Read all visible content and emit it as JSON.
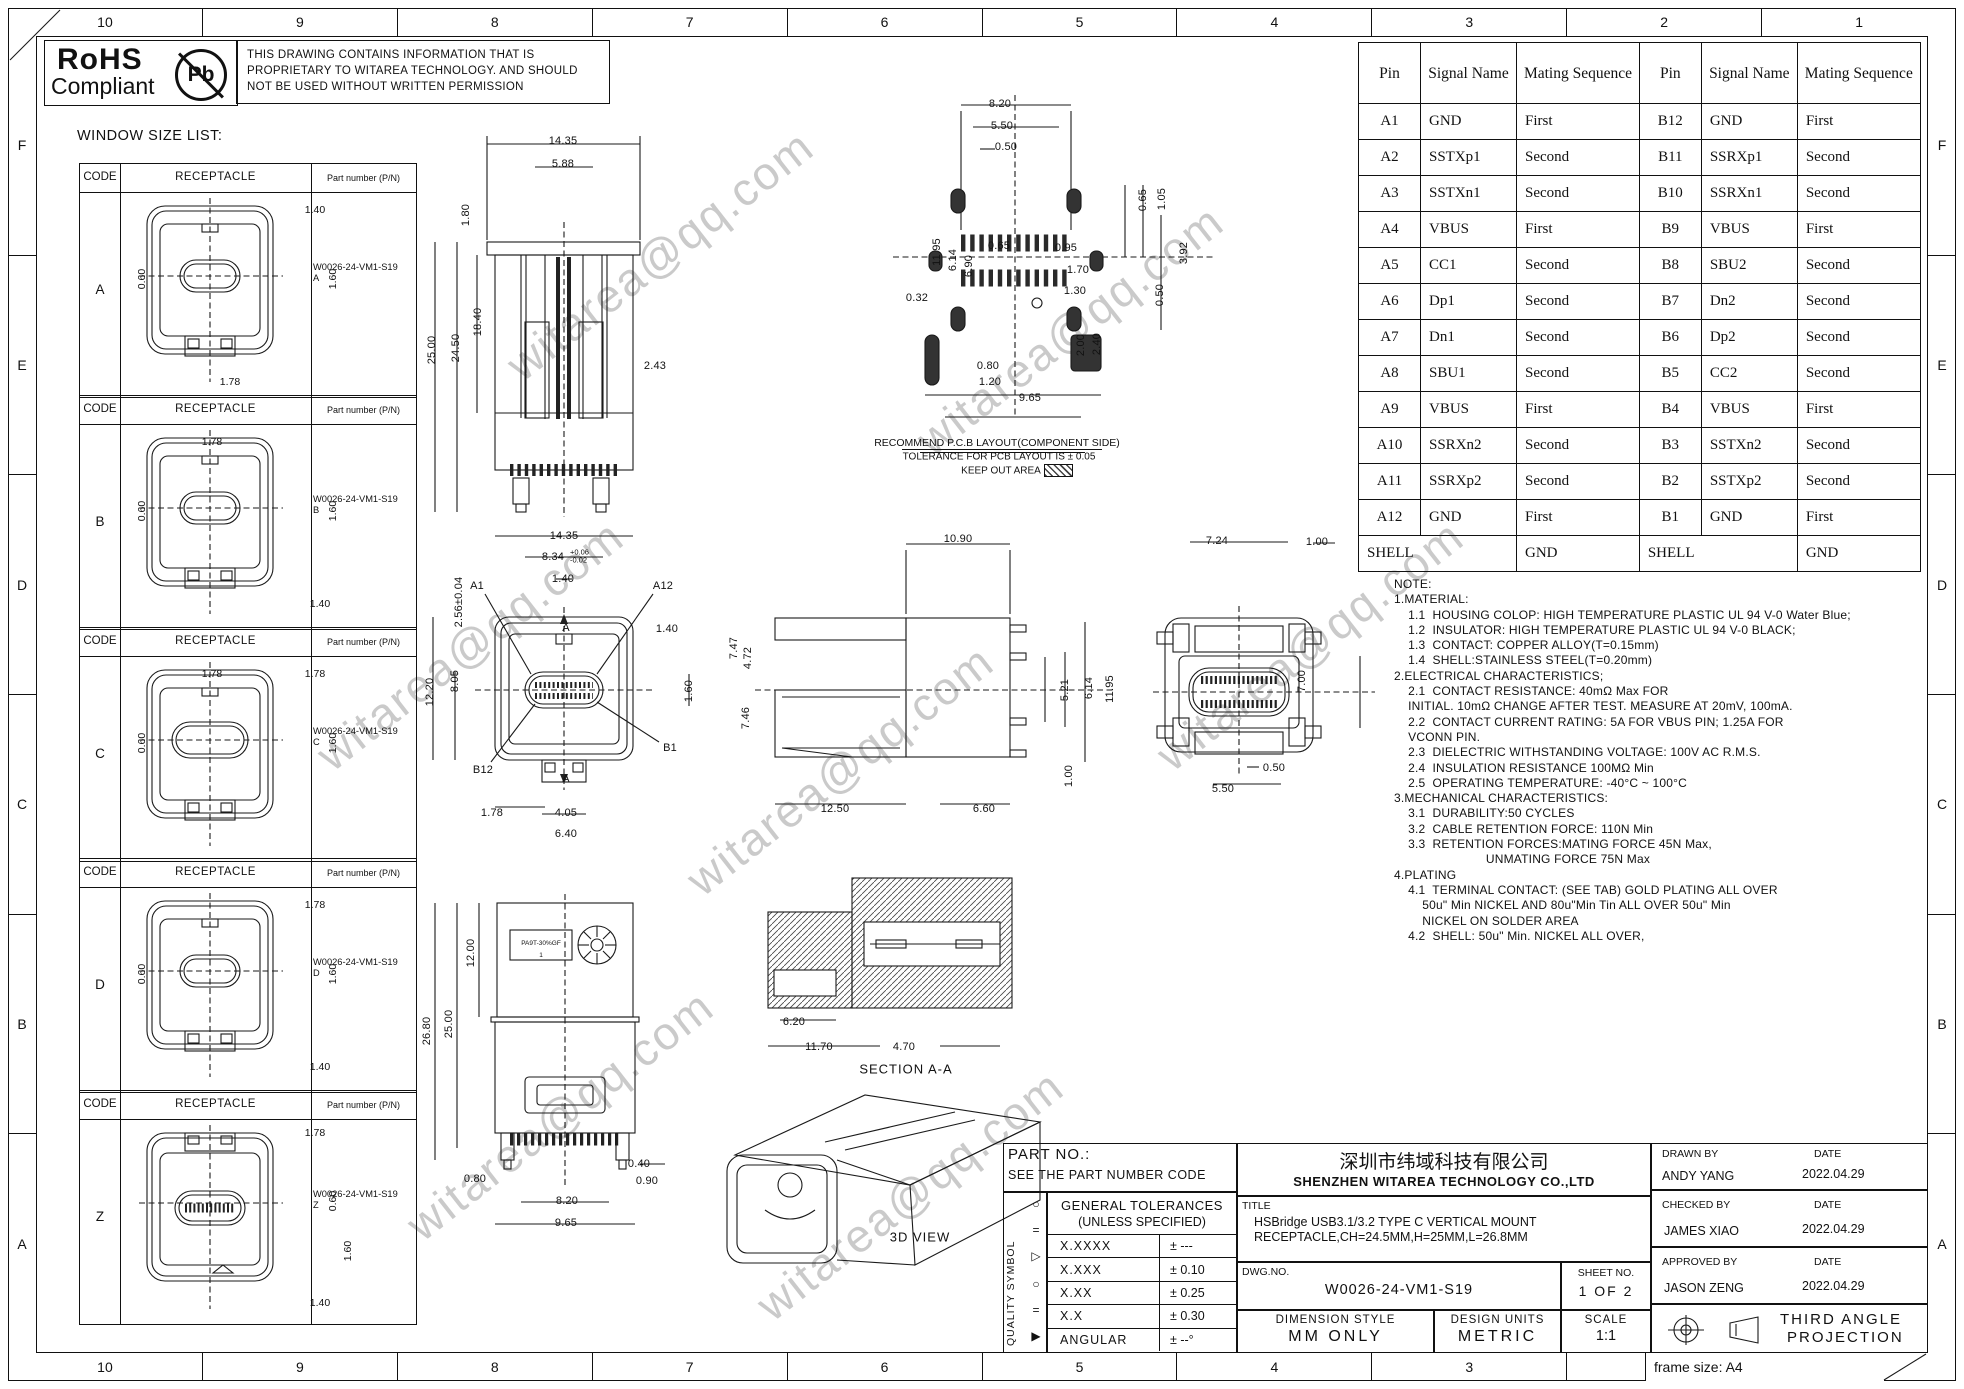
{
  "sheet": {
    "frame_size": "frame size: A4"
  },
  "grid": {
    "cols": [
      "10",
      "9",
      "8",
      "7",
      "6",
      "5",
      "4",
      "3",
      "2",
      "1"
    ],
    "rows": [
      "F",
      "E",
      "D",
      "C",
      "B",
      "A"
    ]
  },
  "header": {
    "rohs": {
      "line1": "RoHS",
      "line2": "Compliant",
      "pb": "Pb"
    },
    "proprietary_lines": [
      "THIS DRAWING CONTAINS INFORMATION THAT IS",
      "PROPRIETARY TO WITAREA TECHNOLOGY. AND SHOULD",
      "NOT BE USED WITHOUT WRITTEN PERMISSION"
    ]
  },
  "window_size_list": {
    "title": "WINDOW SIZE LIST:",
    "headers": {
      "code": "CODE",
      "receptacle": "RECEPTACLE",
      "part": "Part number (P/N)"
    },
    "rows": [
      {
        "code": "A",
        "part": "W0026-24-VM1-S19",
        "suffix": "A",
        "dims": {
          "d1": "1.40",
          "d2": "1.60",
          "d3": "0.60",
          "d4": "1.78"
        }
      },
      {
        "code": "B",
        "part": "W0026-24-VM1-S19",
        "suffix": "B",
        "dims": {
          "d1": "1.78",
          "d2": "0.60",
          "d3": "1.60",
          "d4": "1.40"
        }
      },
      {
        "code": "C",
        "part": "W0026-24-VM1-S19",
        "suffix": "C",
        "dims": {
          "d1": "1.78",
          "d2": "1.78",
          "d3": "0.60",
          "d4": "1.60"
        }
      },
      {
        "code": "D",
        "part": "W0026-24-VM1-S19",
        "suffix": "D",
        "dims": {
          "d1": "1.78",
          "d2": "0.60",
          "d3": "1.60",
          "d4": "1.40"
        }
      },
      {
        "code": "Z",
        "part": "W0026-24-VM1-S19",
        "suffix": "Z",
        "dims": {
          "d1": "1.78",
          "d2": "0.60",
          "d3": "1.60",
          "d4": "1.40"
        }
      }
    ]
  },
  "pin_table": {
    "headers": [
      "Pin",
      "Signal Name",
      "Mating Sequence"
    ],
    "a_side": [
      [
        "A1",
        "GND",
        "First"
      ],
      [
        "A2",
        "SSTXp1",
        "Second"
      ],
      [
        "A3",
        "SSTXn1",
        "Second"
      ],
      [
        "A4",
        "VBUS",
        "First"
      ],
      [
        "A5",
        "CC1",
        "Second"
      ],
      [
        "A6",
        "Dp1",
        "Second"
      ],
      [
        "A7",
        "Dn1",
        "Second"
      ],
      [
        "A8",
        "SBU1",
        "Second"
      ],
      [
        "A9",
        "VBUS",
        "First"
      ],
      [
        "A10",
        "SSRXn2",
        "Second"
      ],
      [
        "A11",
        "SSRXp2",
        "Second"
      ],
      [
        "A12",
        "GND",
        "First"
      ]
    ],
    "b_side": [
      [
        "B12",
        "GND",
        "First"
      ],
      [
        "B11",
        "SSRXp1",
        "Second"
      ],
      [
        "B10",
        "SSRXn1",
        "Second"
      ],
      [
        "B9",
        "VBUS",
        "First"
      ],
      [
        "B8",
        "SBU2",
        "Second"
      ],
      [
        "B7",
        "Dn2",
        "Second"
      ],
      [
        "B6",
        "Dp2",
        "Second"
      ],
      [
        "B5",
        "CC2",
        "Second"
      ],
      [
        "B4",
        "VBUS",
        "First"
      ],
      [
        "B3",
        "SSTXn2",
        "Second"
      ],
      [
        "B2",
        "SSTXp2",
        "Second"
      ],
      [
        "B1",
        "GND",
        "First"
      ]
    ],
    "shell": {
      "label": "SHELL",
      "value": "GND"
    }
  },
  "notes_lines": [
    "NOTE:",
    "1.MATERIAL:",
    "    1.1  HOUSING COLOP: HIGH TEMPERATURE PLASTIC UL 94 V-0 Water Blue;",
    "    1.2  INSULATOR: HIGH TEMPERATURE PLASTIC UL 94 V-0 BLACK;",
    "    1.3  CONTACT: COPPER ALLOY(T=0.15mm)",
    "    1.4  SHELL:STAINLESS STEEL(T=0.20mm)",
    "2.ELECTRICAL CHARACTERISTICS;",
    "    2.1  CONTACT RESISTANCE: 40mΩ Max FOR",
    "    INITIAL. 10mΩ CHANGE AFTER TEST. MEASURE AT 20mV, 100mA.",
    "    2.2  CONTACT CURRENT RATING: 5A FOR VBUS PIN; 1.25A FOR",
    "    VCONN PIN.",
    "    2.3  DIELECTRIC WITHSTANDING VOLTAGE: 100V AC R.M.S.",
    "    2.4  INSULATION RESISTANCE 100MΩ Min",
    "    2.5  OPERATING TEMPERATURE: -40°C ~ 100°C",
    "3.MECHANICAL CHARACTERISTICS:",
    "    3.1  DURABILITY:50 CYCLES",
    "    3.2  CABLE RETENTION FORCE: 110N Min",
    "    3.3  RETENTION FORCES:MATING FORCE 45N Max,",
    "                          UNMATING FORCE 75N Max",
    "4.PLATING",
    "    4.1  TERMINAL CONTACT: (SEE TAB) GOLD PLATING ALL OVER",
    "        50u\" Min NICKEL AND 80u\"Min Tin ALL OVER 50u\" Min",
    "        NICKEL ON SOLDER AREA",
    "    4.2  SHELL: 50u\" Min. NICKEL ALL OVER,"
  ],
  "views": {
    "front": {
      "dims": [
        "14.35",
        "5.88",
        "1.80",
        "25.00",
        "24.50",
        "18.40",
        "2.43"
      ]
    },
    "pcb": {
      "dims": [
        "8.20",
        "5.50",
        "0.50",
        "0.65",
        "1.05",
        "3.92",
        "0.65",
        "0.95",
        "1.70",
        "1.30",
        "0.50",
        "0.32",
        "2.00",
        "2.40",
        "0.80",
        "1.20",
        "9.65",
        "11.95",
        "6.14",
        "6.90"
      ],
      "captions": [
        "RECOMMEND P.C.B LAYOUT(COMPONENT SIDE)",
        "TOLERANCE FOR PCB LAYOUT IS ± 0.05",
        "KEEP OUT AREA"
      ]
    },
    "plan": {
      "dims": [
        "14.35",
        "1.40",
        "A1",
        "A12",
        "2.56±0.04",
        "1.40",
        "12.20",
        "8.05",
        "1.60",
        "B12",
        "B1",
        "A",
        "A",
        "1.78",
        "4.05",
        "6.40"
      ],
      "tol": {
        "base": "8.34",
        "plus": "+0.06",
        "minus": "-0.02"
      }
    },
    "side": {
      "dims": [
        "10.90",
        "7.47",
        "4.72",
        "7.46",
        "5.21",
        "6.14",
        "11.95",
        "1.00",
        "12.50",
        "6.60"
      ]
    },
    "rear": {
      "dims": [
        "7.24",
        "1.00",
        "7.00",
        "0.50",
        "5.50"
      ]
    },
    "bottom": {
      "dims": [
        "12.00",
        "25.00",
        "26.80",
        "0.40",
        "0.80",
        "0.90",
        "8.20",
        "9.65"
      ],
      "marking1": "PA9T-30%GF",
      "marking2": "1"
    },
    "section": {
      "dims": [
        "6.20",
        "11.70",
        "4.70"
      ],
      "label": "SECTION A-A"
    },
    "three_d": {
      "label": "3D VIEW"
    }
  },
  "title_block": {
    "part_no_label": "PART NO.:",
    "part_no_value": "SEE THE PART NUMBER CODE",
    "quality_label": "QUALITY SYMBOL",
    "quality_symbols": [
      "○",
      "=",
      "▷",
      "○",
      "=",
      "▶"
    ],
    "tol_header1": "GENERAL TOLERANCES",
    "tol_header2": "(UNLESS SPECIFIED)",
    "tol_rows": [
      [
        "X.XXXX",
        "± ---"
      ],
      [
        "X.XXX",
        "± 0.10"
      ],
      [
        "X.XX",
        "± 0.25"
      ],
      [
        "X.X",
        "± 0.30"
      ],
      [
        "ANGULAR",
        "± --°"
      ]
    ],
    "company_cn": "深圳市纬域科技有限公司",
    "company_en": "SHENZHEN WITAREA TECHNOLOGY CO.,LTD",
    "title_label": "TITLE",
    "title_line1": "HSBridge USB3.1/3.2 TYPE C VERTICAL MOUNT",
    "title_line2": "RECEPTACLE,CH=24.5MM,H=25MM,L=26.8MM",
    "dwg_label": "DWG.NO.",
    "dwg_no": "W0026-24-VM1-S19",
    "sheet_label": "SHEET NO.",
    "sheet_value": "1 OF 2",
    "dim_style_label": "DIMENSION STYLE",
    "dim_style_value": "MM ONLY",
    "design_units_label": "DESIGN UNITS",
    "design_units_value": "METRIC",
    "scale_label": "SCALE",
    "scale_value": "1:1",
    "drawn_label": "DRAWN BY",
    "date_label": "DATE",
    "drawn_by": "ANDY YANG",
    "drawn_date": "2022.04.29",
    "checked_label": "CHECKED BY",
    "checked_by": "JAMES XIAO",
    "checked_date": "2022.04.29",
    "approved_label": "APPROVED BY",
    "approved_by": "JASON ZENG",
    "approved_date": "2022.04.29",
    "projection_line1": "THIRD ANGLE",
    "projection_line2": "PROJECTION"
  },
  "watermark": {
    "text": "witarea@qq.com"
  }
}
